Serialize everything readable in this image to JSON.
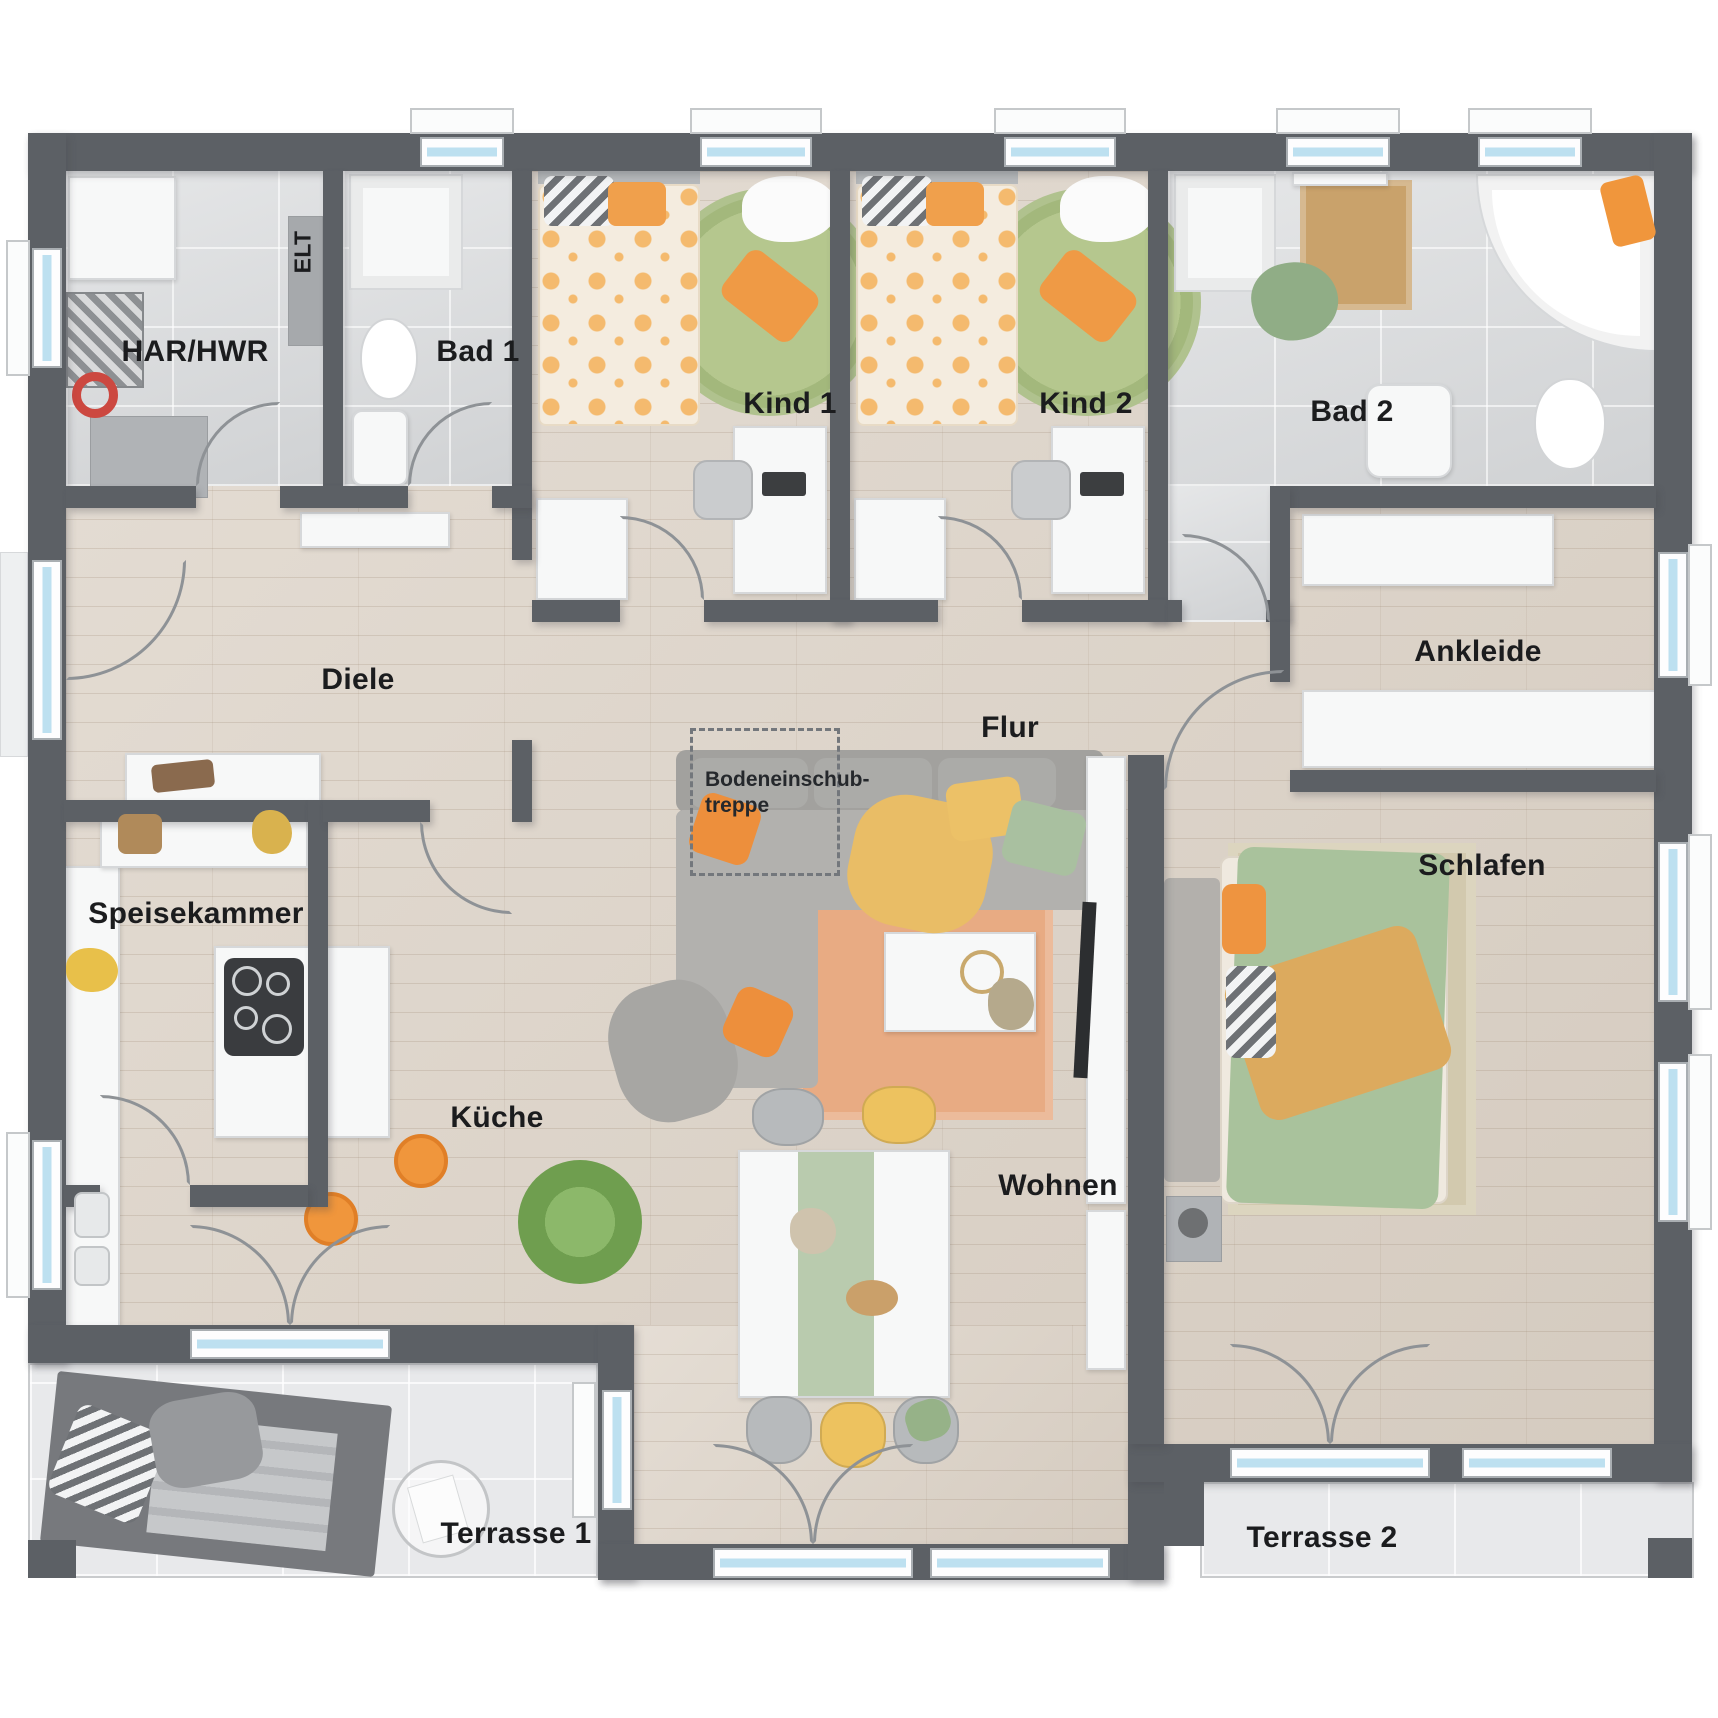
{
  "plan_type": "residential-floor-plan-top-view",
  "rooms": {
    "har_hwr": {
      "label": "HAR/HWR"
    },
    "elt": {
      "label": "ELT"
    },
    "bad1": {
      "label": "Bad 1"
    },
    "kind1": {
      "label": "Kind 1"
    },
    "kind2": {
      "label": "Kind 2"
    },
    "bad2": {
      "label": "Bad 2"
    },
    "diele": {
      "label": "Diele"
    },
    "flur": {
      "label": "Flur"
    },
    "ankleide": {
      "label": "Ankleide"
    },
    "speisekammer": {
      "label": "Speisekammer"
    },
    "kueche": {
      "label": "Küche"
    },
    "wohnen": {
      "label": "Wohnen"
    },
    "schlafen": {
      "label": "Schlafen"
    },
    "terrasse1": {
      "label": "Terrasse 1"
    },
    "terrasse2": {
      "label": "Terrasse 2"
    }
  },
  "annotations": {
    "attic_stair_line1": "Bodeneinschub-",
    "attic_stair_line2": "treppe"
  },
  "colors": {
    "wall": "#5c6065",
    "wood_floor": "#dcd2c6",
    "bath_tile": "#d8dadc",
    "terrace_tile": "#e8e9eb",
    "window_glass": "#bde0f0",
    "accent_orange": "#ef9a45",
    "accent_yellow": "#e9bd66",
    "accent_green": "#a9c09c",
    "rug_terracotta": "#e8ab83",
    "rug_green": "#a9bd82",
    "label_text": "#1b1c1e"
  }
}
